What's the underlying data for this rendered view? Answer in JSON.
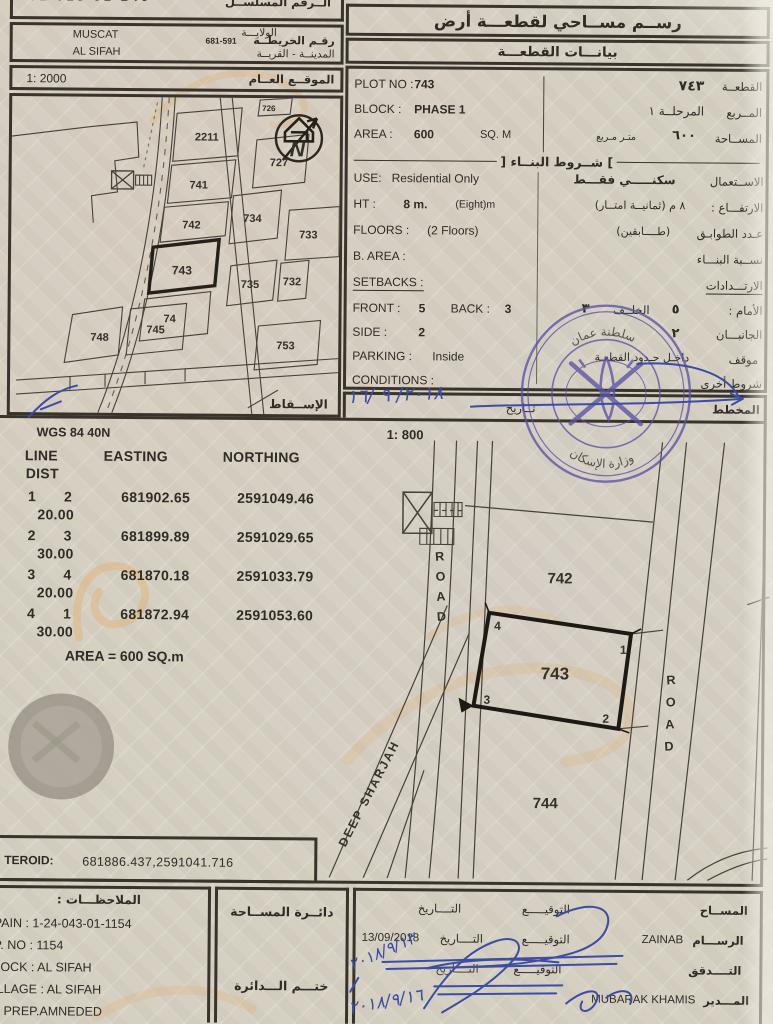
{
  "palette": {
    "ink": "#2f2c26",
    "line": "#38342c",
    "blue_ink": "#3c4da3",
    "stamp": "#5b53a3",
    "watermark": "#dfb277",
    "paper": "#d6d0c3"
  },
  "header_left": {
    "serial_label": "الــرقم المسلســل",
    "serial_value": "01 013 01 140",
    "wilaya_label": "الولايـــة",
    "wilaya_value": "MUSCAT",
    "map_no_label": "رقـم الخريطــة",
    "map_no_value": "681-591",
    "city_label": "المدينــة - القريــة",
    "city_value": "AL SIFAH",
    "location_label": "الموقــع العــام",
    "location_scale": "1: 2000",
    "projection_label": "الإســقاط"
  },
  "header_right": {
    "title": "رســم مســاحي لقطعـــة أرض",
    "subtitle": "بيانـــات القطعـــة"
  },
  "plot_info": {
    "plot_no_label": "PLOT NO :",
    "plot_no_value": "743",
    "plot_no_ar_value": "٧٤٣",
    "plot_no_ar_label": "القطعــة",
    "block_label": "BLOCK :",
    "block_value": "PHASE 1",
    "block_ar_value": "المرحلــة ١",
    "block_ar_label": "المــربع",
    "area_label": "AREA :",
    "area_value": "600",
    "area_unit": "SQ. M",
    "area_ar_value": "٦٠٠",
    "area_ar_unit": "متـر مـربع",
    "area_ar_label": "المســاحة"
  },
  "building": {
    "header": "شــروط البنــاء",
    "use_label": "USE:",
    "use_value": "Residential Only",
    "use_ar_value": "سكنـــــي فقـــط",
    "use_ar_label": "الاســتعمال",
    "ht_label": "HT :",
    "ht_value": "8 m.",
    "ht_note": "(Eight)m",
    "ht_ar_value": "٨  م (ثمانيــة امتــار)",
    "ht_ar_label": "الارتفـــاع :",
    "floors_label": "FLOORS :",
    "floors_value": "(2 Floors)",
    "floors_ar_value": "(طــــابقين)",
    "floors_ar_label": "عـدد الطوابـق",
    "barea_label": "B. AREA :",
    "barea_ar_label": "نســبة البنـــاء",
    "setbacks_label": "SETBACKS :",
    "setbacks_ar_label": "الارتـــدادات",
    "front_label": "FRONT :",
    "front_value": "5",
    "back_label": "BACK :",
    "back_value": "3",
    "front_ar_label": "الأمام :",
    "front_ar_value": "٥",
    "back_ar_label": "الخلــف",
    "back_ar_value": "٣",
    "side_label": "SIDE :",
    "side_value": "2",
    "side_ar_label": "الجانبـــان",
    "side_ar_value": "٢",
    "parking_label": "PARKING :",
    "parking_value": "Inside",
    "parking_ar_label": "موقف",
    "parking_ar_value": "داخـل حـدود القطعـة",
    "conditions_label": "CONDITIONS :",
    "conditions_ar_label": "شروط أخرى",
    "planner_label": "المخطط",
    "planner_date_label": "تــاريخ"
  },
  "site_map": {
    "labels": {
      "p2211": "2211",
      "p741": "741",
      "p742": "742",
      "p743": "743",
      "p744": "74",
      "p727": "727",
      "p726": "726",
      "p734": "734",
      "p733": "733",
      "p735": "735",
      "p732": "732",
      "p748": "748",
      "p745": "745",
      "p753": "753"
    },
    "north": "N",
    "subject_plot": "743"
  },
  "survey": {
    "datum": "WGS 84  40N",
    "scale": "1: 800",
    "table": {
      "headers": [
        "LINE",
        "EASTING",
        "NORTHING",
        "DIST"
      ],
      "rows": [
        [
          "1",
          "2",
          "681902.65",
          "2591049.46",
          "20.00"
        ],
        [
          "2",
          "3",
          "681899.89",
          "2591029.65",
          "30.00"
        ],
        [
          "3",
          "4",
          "681870.18",
          "2591033.79",
          "20.00"
        ],
        [
          "4",
          "1",
          "681872.94",
          "2591053.60",
          "30.00"
        ]
      ],
      "area_note": "AREA = 600  SQ.m"
    },
    "centroid_label": "TEROID:",
    "centroid_value": "681886.437,2591041.716"
  },
  "detail_map": {
    "road_left": {
      "l1": "R",
      "l2": "O",
      "l3": "A",
      "l4": "D"
    },
    "road_right": {
      "l1": "R",
      "l2": "O",
      "l3": "A",
      "l4": "D"
    },
    "deep_label": "DEEP SHARJAH",
    "plot_above": "742",
    "plot_subject": "743",
    "plot_below": "744",
    "corners": {
      "c1": "1",
      "c2": "2",
      "c3": "3",
      "c4": "4"
    }
  },
  "stamp": {
    "top_text": "سلطنة عمان",
    "bottom_text": "وزارة الإسكان"
  },
  "handwriting": {
    "planner_date": "٢٠١٨/ ٩ /١٦",
    "check_date": "٢٠١٨/٩/١٣",
    "approve_date": "٢٠١٨/٩/١٦"
  },
  "footer": {
    "notes_label": "الملاحظـــات :",
    "notes": [
      "PAIN : 1-24-043-01-1154",
      "P. NO : 1154",
      "LOCK : AL SIFAH",
      "ILLAGE : AL SIFAH",
      "d PREP.AMNEDED"
    ],
    "dept_label": "دائــرة المســاحة",
    "dept_stamp_label": "ختـــم الـــدائرة",
    "sign": {
      "sig_label": "التوقيـــــع",
      "date_label": "التــــاريخ",
      "rows": [
        {
          "role": "المســاح",
          "name": "",
          "date": ""
        },
        {
          "role": "الرســـام",
          "name": "ZAINAB",
          "date": "13/09/2018"
        },
        {
          "role": "التــــدقق",
          "name": "",
          "date": ""
        },
        {
          "role": "المـــدير",
          "name": "MUBARAK KHAMIS",
          "date": ""
        }
      ]
    }
  }
}
